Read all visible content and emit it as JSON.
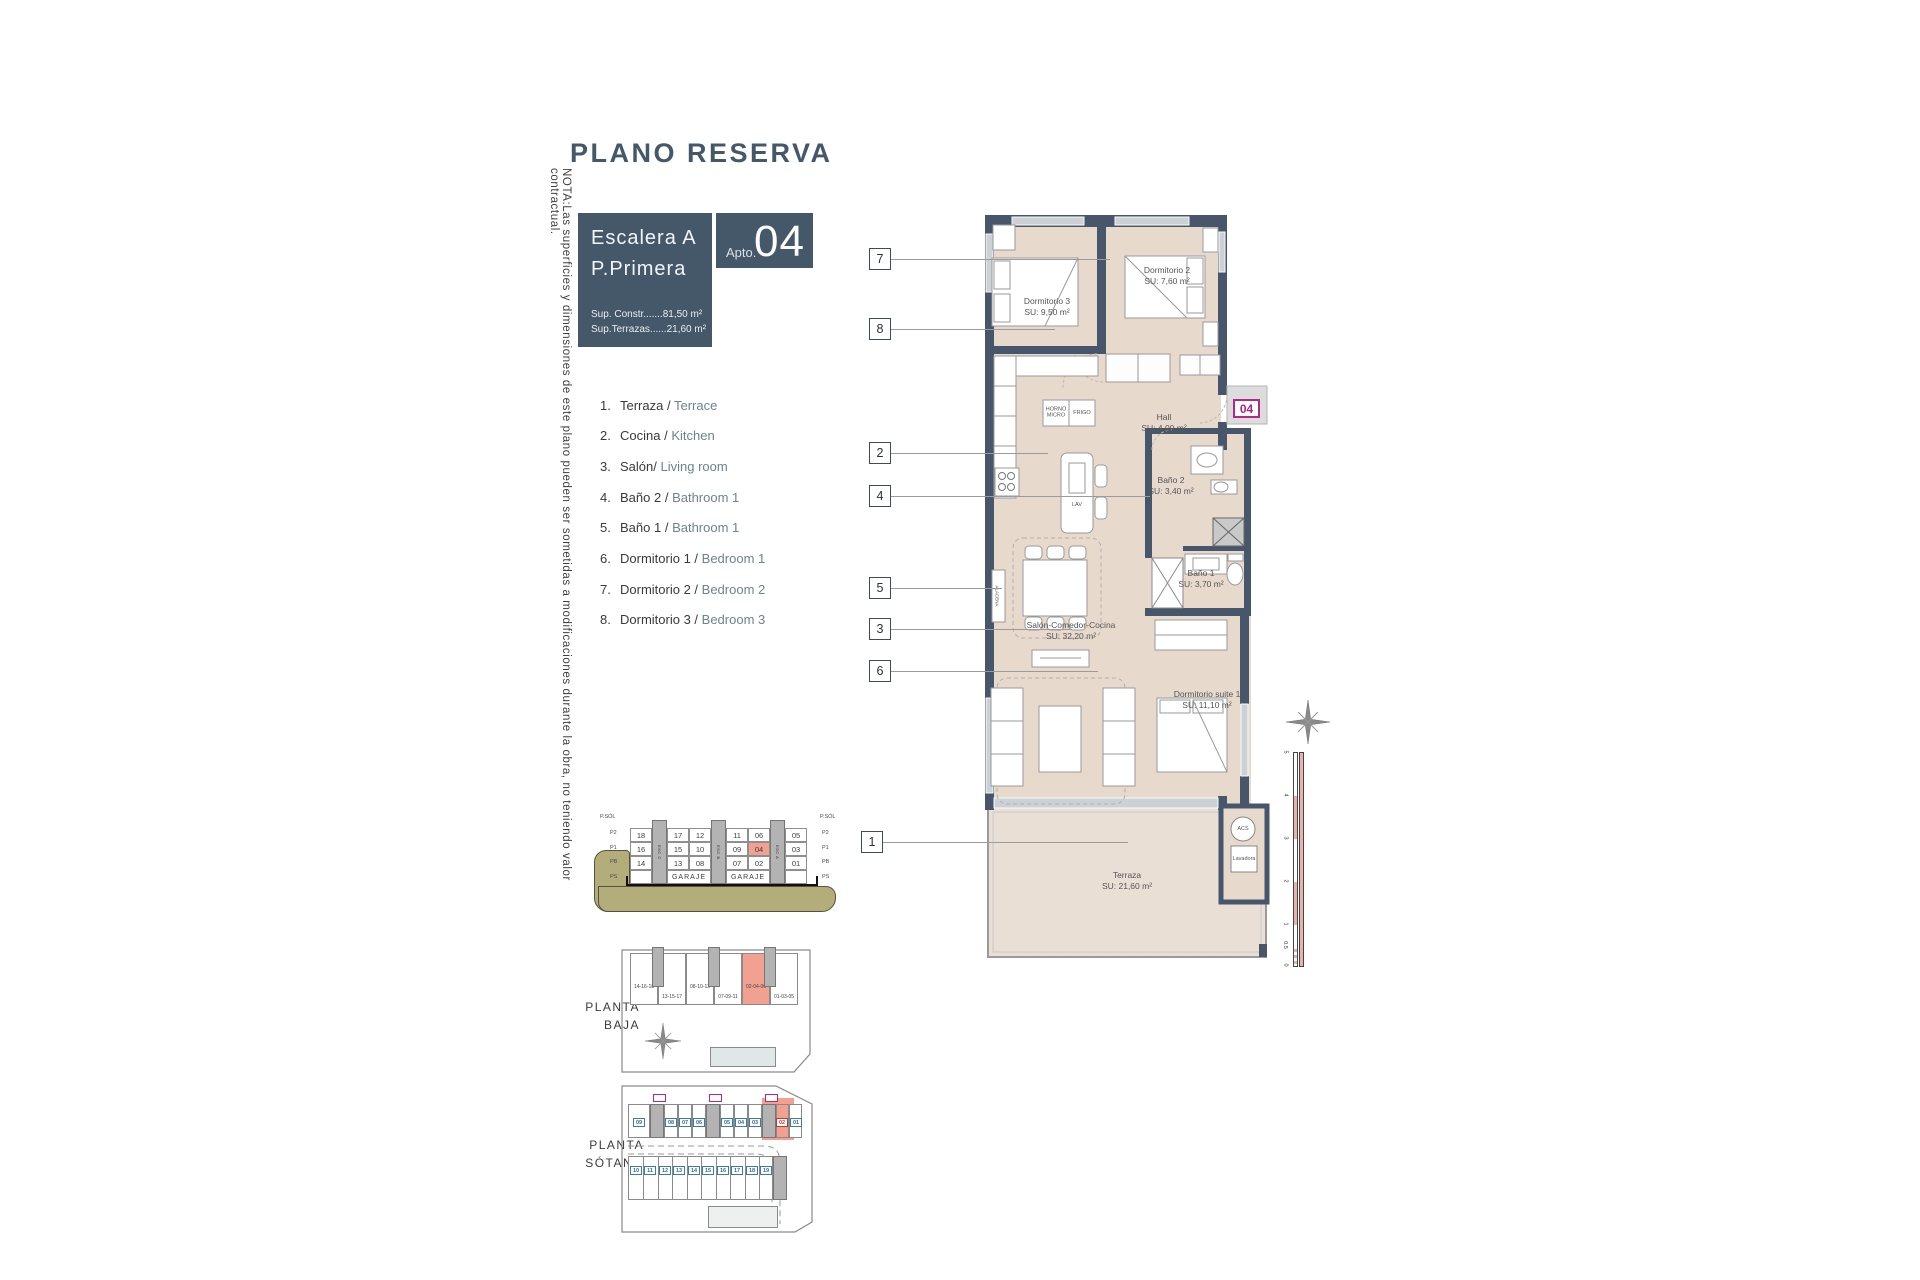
{
  "title": "PLANO RESERVA",
  "side_note": "NOTA:Las superficies y dimensiones de este plano pueden ser sometidas a modificaciones durante la obra, no teniendo valor contractual.",
  "info_box": {
    "line1": "Escalera A",
    "line2": "P.Primera",
    "sup_constr": "Sup. Constr.......81,50 m²",
    "sup_terrazas": "Sup.Terrazas......21,60 m²"
  },
  "apto_box": {
    "prefix": "Apto.",
    "number": "04"
  },
  "legend": [
    {
      "num": "1.",
      "es": "Terraza /",
      "en": "Terrace"
    },
    {
      "num": "2.",
      "es": "Cocina /",
      "en": "Kitchen"
    },
    {
      "num": "3.",
      "es": "Salón/",
      "en": "Living room"
    },
    {
      "num": "4.",
      "es": "Baño 2 /",
      "en": "Bathroom 1"
    },
    {
      "num": "5.",
      "es": "Baño 1 /",
      "en": "Bathroom 1"
    },
    {
      "num": "6.",
      "es": "Dormitorio 1 /",
      "en": "Bedroom 1"
    },
    {
      "num": "7.",
      "es": "Dormitorio 2 /",
      "en": "Bedroom 2"
    },
    {
      "num": "8.",
      "es": "Dormitorio 3 /",
      "en": "Bedroom 3"
    }
  ],
  "callouts": [
    "7",
    "8",
    "2",
    "4",
    "5",
    "3",
    "6",
    "1"
  ],
  "plan": {
    "entry_badge": "04",
    "rooms": {
      "dorm3": {
        "name": "Dormitorio 3",
        "area": "SU: 9,50 m²"
      },
      "dorm2": {
        "name": "Dormitorio 2",
        "area": "SU: 7,60 m²"
      },
      "hall": {
        "name": "Hall",
        "area": "SU: 4,00 m²"
      },
      "bano2": {
        "name": "Baño 2",
        "area": "SU: 3,40 m²"
      },
      "bano1": {
        "name": "Baño 1",
        "area": "SU: 3,70 m²"
      },
      "salon": {
        "name": "Salón-Comedor-Cocina",
        "area": "SU: 32,20 m²"
      },
      "suite": {
        "name": "Dormitorio suite 1",
        "area": "SU: 11,10 m²"
      },
      "terraza": {
        "name": "Terraza",
        "area": "SU: 21,60 m²"
      }
    },
    "labels": {
      "horno": "HORNO\nMICRO",
      "frigo": "FRIGO",
      "lav": "LAV",
      "alacena": "ALACENA",
      "acs": "ACS",
      "lavadora": "Lavadora"
    }
  },
  "section": {
    "rows": [
      [
        "18",
        "17",
        "12",
        "11",
        "06",
        "05"
      ],
      [
        "16",
        "15",
        "10",
        "09",
        "04",
        "03"
      ],
      [
        "14",
        "13",
        "08",
        "07",
        "02",
        "01"
      ]
    ],
    "garage": [
      "GARAJE",
      "GARAJE"
    ],
    "stairs": [
      "ESC C",
      "ESC B",
      "ESC A"
    ],
    "floors_left": [
      "P.SÓL",
      "P2",
      "P1",
      "PB",
      "PS"
    ],
    "floors_right": [
      "P.SÓL",
      "P2",
      "P1",
      "PB",
      "PS"
    ]
  },
  "planta_baja": {
    "label": "PLANTA\nBAJA",
    "blocks": [
      "14-16-18",
      "13-15-17",
      "08-10-12",
      "07-09-11",
      "02-04-06",
      "01-03-05"
    ]
  },
  "planta_sotano": {
    "label": "PLANTA\nSÓTANO",
    "top_row": [
      "09",
      "08",
      "07",
      "06",
      "05",
      "04",
      "03",
      "02",
      "01"
    ],
    "bottom_row": [
      "10",
      "11",
      "12",
      "13",
      "14",
      "15",
      "16",
      "17",
      "18",
      "19"
    ]
  },
  "scale_bar": [
    "5",
    "4",
    "3",
    "2",
    "1",
    "0.5",
    "0"
  ],
  "colors": {
    "brand_dark": "#44586a",
    "room_fill": "#e7dacd",
    "highlight_salmon": "#f2a08f",
    "badge_magenta": "#b5268d"
  }
}
